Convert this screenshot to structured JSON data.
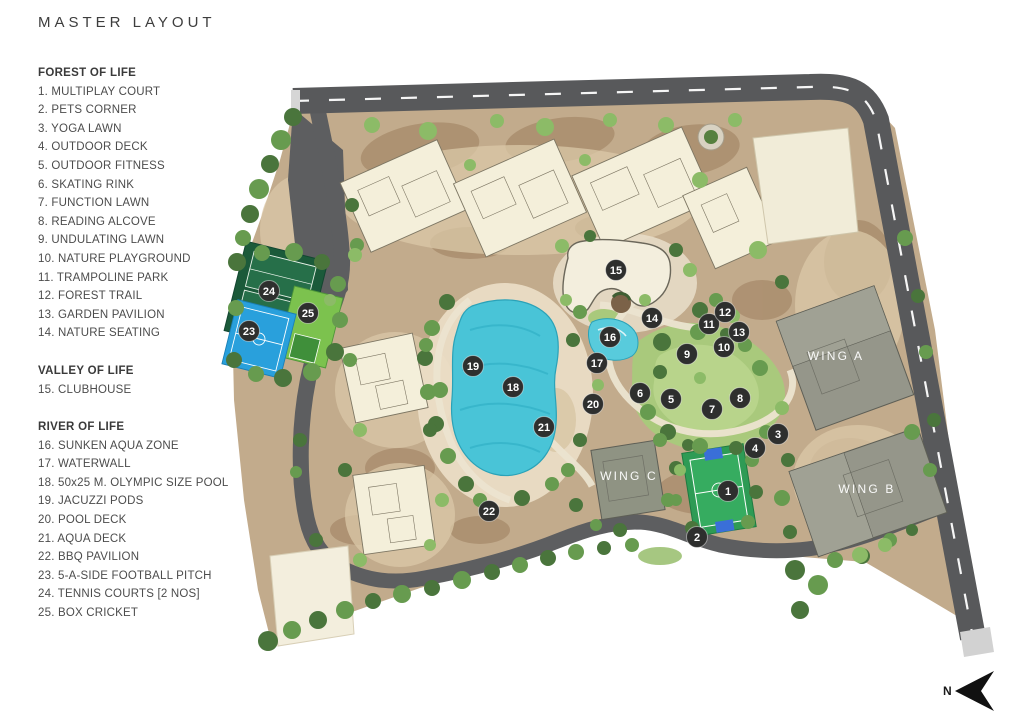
{
  "title": "MASTER LAYOUT",
  "legend": {
    "sections": [
      {
        "heading": "FOREST OF LIFE",
        "items": [
          "1. MULTIPLAY COURT",
          "2. PETS CORNER",
          "3. YOGA LAWN",
          "4. OUTDOOR DECK",
          "5. OUTDOOR FITNESS",
          "6. SKATING RINK",
          "7. FUNCTION LAWN",
          "8. READING ALCOVE",
          "9. UNDULATING LAWN",
          "10. NATURE PLAYGROUND",
          "11. TRAMPOLINE PARK",
          "12. FOREST TRAIL",
          "13. GARDEN PAVILION",
          "14. NATURE SEATING"
        ]
      },
      {
        "heading": "VALLEY OF LIFE",
        "items": [
          "15. CLUBHOUSE"
        ]
      },
      {
        "heading": "RIVER OF LIFE",
        "items": [
          "16. SUNKEN AQUA ZONE",
          "17. WATERWALL",
          "18. 50x25 M. OLYMPIC SIZE POOL",
          "19. JACUZZI PODS",
          "20. POOL DECK",
          "21. AQUA DECK",
          "22. BBQ PAVILION",
          "23. 5-A-SIDE FOOTBALL PITCH",
          "24. TENNIS COURTS [2 NOS]",
          "25. BOX CRICKET"
        ]
      }
    ]
  },
  "map": {
    "wing_labels": [
      {
        "label": "WING A",
        "x": 836,
        "y": 360
      },
      {
        "label": "WING B",
        "x": 867,
        "y": 493
      },
      {
        "label": "WING C",
        "x": 629,
        "y": 480
      }
    ],
    "markers": [
      {
        "n": "1",
        "x": 728,
        "y": 491
      },
      {
        "n": "2",
        "x": 697,
        "y": 537
      },
      {
        "n": "3",
        "x": 778,
        "y": 434
      },
      {
        "n": "4",
        "x": 755,
        "y": 448
      },
      {
        "n": "5",
        "x": 671,
        "y": 399
      },
      {
        "n": "6",
        "x": 640,
        "y": 393
      },
      {
        "n": "7",
        "x": 712,
        "y": 409
      },
      {
        "n": "8",
        "x": 740,
        "y": 398
      },
      {
        "n": "9",
        "x": 687,
        "y": 354
      },
      {
        "n": "10",
        "x": 724,
        "y": 347
      },
      {
        "n": "11",
        "x": 709,
        "y": 324
      },
      {
        "n": "12",
        "x": 725,
        "y": 312
      },
      {
        "n": "13",
        "x": 739,
        "y": 332
      },
      {
        "n": "14",
        "x": 652,
        "y": 318
      },
      {
        "n": "15",
        "x": 616,
        "y": 270
      },
      {
        "n": "16",
        "x": 610,
        "y": 337
      },
      {
        "n": "17",
        "x": 597,
        "y": 363
      },
      {
        "n": "18",
        "x": 513,
        "y": 387
      },
      {
        "n": "19",
        "x": 473,
        "y": 366
      },
      {
        "n": "20",
        "x": 593,
        "y": 404
      },
      {
        "n": "21",
        "x": 544,
        "y": 427
      },
      {
        "n": "22",
        "x": 489,
        "y": 511
      },
      {
        "n": "23",
        "x": 249,
        "y": 331
      },
      {
        "n": "24",
        "x": 269,
        "y": 291
      },
      {
        "n": "25",
        "x": 308,
        "y": 313
      }
    ],
    "compass": {
      "label": "N"
    }
  },
  "colors": {
    "road": "#58595b",
    "road_dash": "#ffffff",
    "terrain": "#c2ab8c",
    "building_cream": "#f4efda",
    "wing_gray": "#95968a",
    "pool": "#49c4d7",
    "lawn": "#a9c97c",
    "tennis_court": "#1b5a3a",
    "box_cricket": "#7cc24e",
    "football_pitch": "#29a0dc",
    "multiplay_court": "#2e9b55",
    "marker": "#2e2f2e",
    "legend_text": "#4a4a4a"
  }
}
